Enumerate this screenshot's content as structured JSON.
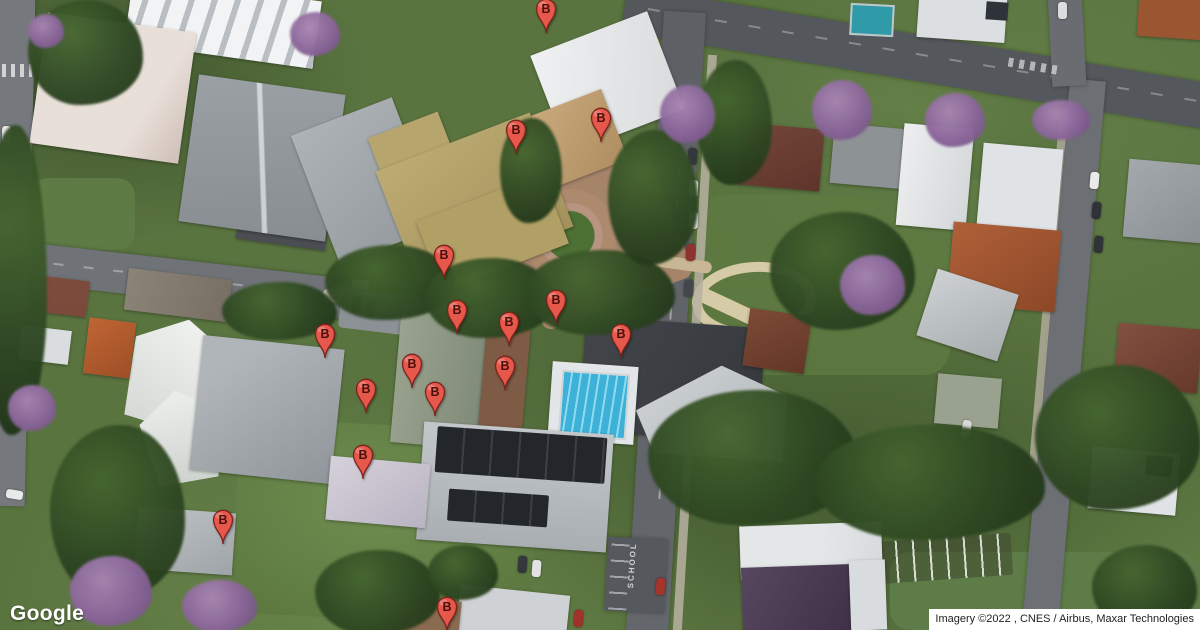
{
  "map": {
    "marker_label": "B",
    "marker_color": "#e6584c",
    "road_marking": "SCHOOL",
    "markers": [
      {
        "x": 546,
        "y": 39
      },
      {
        "x": 516,
        "y": 160
      },
      {
        "x": 601,
        "y": 148
      },
      {
        "x": 444,
        "y": 285
      },
      {
        "x": 457,
        "y": 340
      },
      {
        "x": 509,
        "y": 352
      },
      {
        "x": 556,
        "y": 330
      },
      {
        "x": 621,
        "y": 364
      },
      {
        "x": 325,
        "y": 364
      },
      {
        "x": 412,
        "y": 394
      },
      {
        "x": 366,
        "y": 419
      },
      {
        "x": 435,
        "y": 422
      },
      {
        "x": 505,
        "y": 396
      },
      {
        "x": 363,
        "y": 485
      },
      {
        "x": 223,
        "y": 550
      },
      {
        "x": 447,
        "y": 637
      }
    ]
  },
  "branding": {
    "logo_text": "Google"
  },
  "attribution": {
    "text": "Imagery ©2022 , CNES / Airbus, Maxar Technologies"
  }
}
